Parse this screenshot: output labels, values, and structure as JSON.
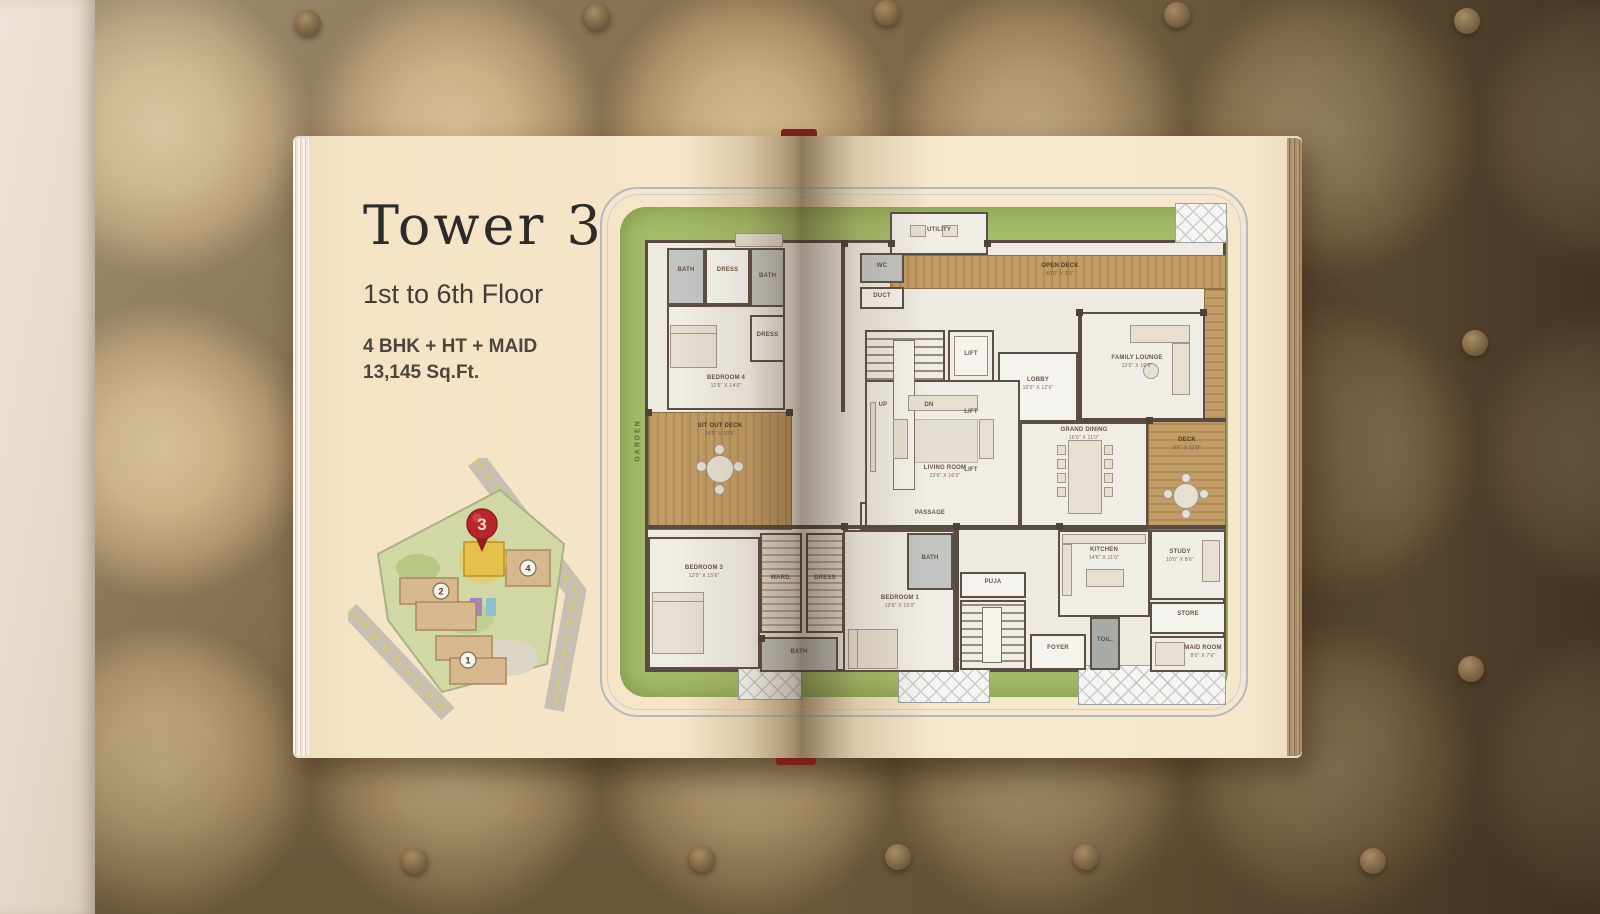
{
  "left_page": {
    "title": "Tower 3",
    "floor_range": "1st to 6th Floor",
    "config": "4 BHK + HT + MAID",
    "area": "13,145 Sq.Ft.",
    "site_plan": {
      "pin_label": "3",
      "tower_labels": [
        "2",
        "1",
        "4"
      ]
    }
  },
  "floor_plan": {
    "garden_label": "GARDEN",
    "rooms": {
      "bath": {
        "name": "BATH"
      },
      "wc": {
        "name": "WC"
      },
      "duct": {
        "name": "DUCT"
      },
      "dress": {
        "name": "DRESS"
      },
      "ward": {
        "name": "WARD."
      },
      "utility": {
        "name": "UTILITY"
      },
      "bed4": {
        "name": "BEDROOM 4",
        "dim": "12'6\" X 14'0\""
      },
      "bed3": {
        "name": "BEDROOM 3",
        "dim": "12'0\" X 15'6\""
      },
      "bed1": {
        "name": "BEDROOM 1",
        "dim": "13'6\" X 15'0\""
      },
      "sitout": {
        "name": "SIT OUT DECK",
        "dim": "14'0\" X 10'6\""
      },
      "living": {
        "name": "LIVING ROOM",
        "dim": "23'6\" X 16'0\""
      },
      "dining": {
        "name": "GRAND DINING",
        "dim": "16'0\" X 11'0\""
      },
      "family": {
        "name": "FAMILY LOUNGE",
        "dim": "13'0\" X 16'6\""
      },
      "deck_top": {
        "name": "OPEN DECK",
        "dim": "40'0\" X 9'0\""
      },
      "deck_right": {
        "name": "DECK",
        "dim": "9'6\" X 12'0\""
      },
      "lobby": {
        "name": "LOBBY",
        "dim": "10'0\" X 12'6\""
      },
      "lift": {
        "name": "LIFT"
      },
      "up": {
        "name": "UP"
      },
      "dn": {
        "name": "DN"
      },
      "passage": {
        "name": "PASSAGE"
      },
      "foyer": {
        "name": "FOYER",
        "dim": "8'0\" X 6'6\""
      },
      "kitchen": {
        "name": "KITCHEN",
        "dim": "14'6\" X 11'0\""
      },
      "study": {
        "name": "STUDY",
        "dim": "10'0\" X 8'6\""
      },
      "store": {
        "name": "STORE"
      },
      "maid": {
        "name": "MAID ROOM",
        "dim": "8'0\" X 7'6\""
      },
      "puja": {
        "name": "PUJA"
      },
      "toilet": {
        "name": "TOIL."
      }
    }
  },
  "colors": {
    "accent_red": "#b5272b",
    "landscape_green": "#a6bc6b",
    "deck_wood": "#c29c66",
    "wall": "#584b41",
    "paper": "#f5e3c6"
  }
}
